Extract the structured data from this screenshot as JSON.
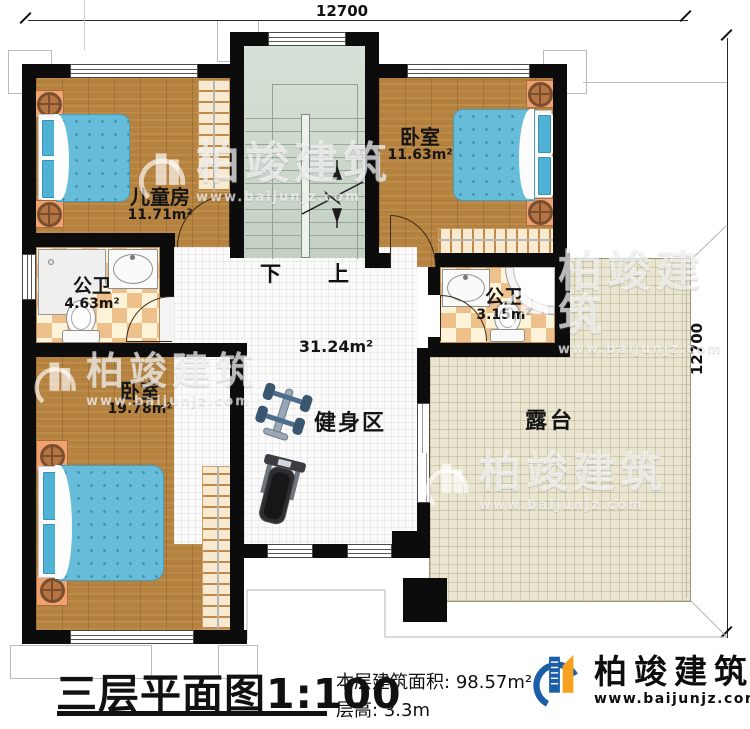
{
  "dimensions": {
    "top": "12700",
    "right": "12700"
  },
  "rooms": {
    "children_room": {
      "name": "儿童房",
      "area": "11.71m²"
    },
    "bedroom_top": {
      "name": "卧室",
      "area": "11.63m²"
    },
    "bath_left": {
      "name": "公卫",
      "area": "4.63m²"
    },
    "bath_right": {
      "name": "公卫",
      "area": "3.15m²"
    },
    "bedroom_bottom": {
      "name": "卧室",
      "area": "19.78m²"
    },
    "fitness": {
      "name": "健身区",
      "hall_area": "31.24m²"
    },
    "terrace": {
      "name": "露台"
    }
  },
  "stairs": {
    "down": "下",
    "up": "上"
  },
  "title": {
    "main": "三层平面图",
    "scale": "1:100",
    "area_label": "本层建筑面积:",
    "area_value": "98.57m²",
    "floor_height_label": "层高:",
    "floor_height_value": "3.3m"
  },
  "brand": {
    "name": "柏竣建筑",
    "url": "www.baijunjz.com"
  },
  "watermark": {
    "name": "柏竣建筑",
    "url": "www.baijunjz.com"
  },
  "colors": {
    "wall": "#0c0c0c",
    "wood": "#b5823f",
    "tile_light": "#fdf3d8",
    "tile_dark": "#eec08b",
    "stair": "#ccd7cc",
    "terrace": "#e9e5d0",
    "bed": "#67bdd9",
    "brand_blue": "#1b5fa8",
    "brand_orange": "#f5a01e"
  }
}
